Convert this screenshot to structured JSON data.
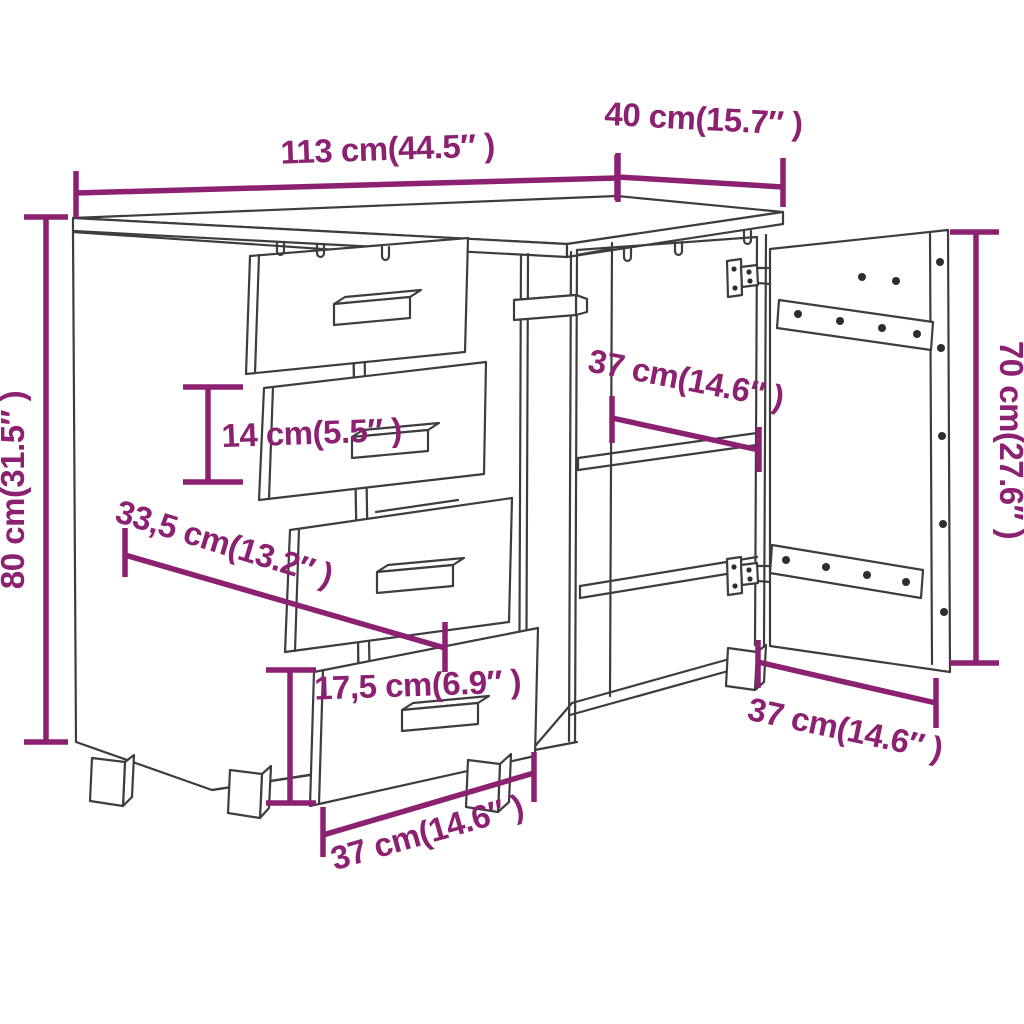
{
  "colors": {
    "line": "#3d3d3d",
    "dimension": "#8B2170",
    "background": "#ffffff"
  },
  "dimensions": {
    "top_width": "113 cm(44.5″ )",
    "top_depth": "40 cm(15.7″ )",
    "total_height": "80 cm(31.5″ )",
    "door_panel_height": "70 cm(27.6″ )",
    "small_drawer_front_height": "14 cm(5.5″ )",
    "left_inner_width": "33,5 cm(13.2″ )",
    "compartment_depth": "37 cm(14.6″ )",
    "large_drawer_front_height": "17,5 cm(6.9″ )",
    "drawer_front_width": "37 cm(14.6″ )",
    "door_panel_width": "37 cm(14.6″ )"
  }
}
